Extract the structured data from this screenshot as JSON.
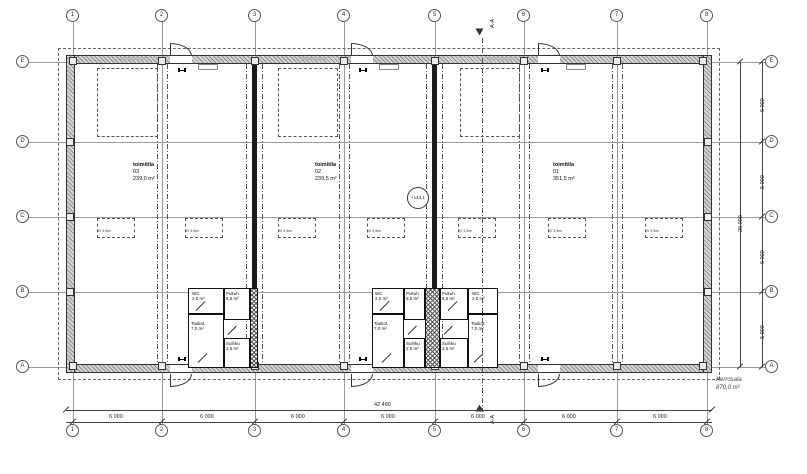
{
  "grid": {
    "cols": [
      "1",
      "2",
      "3",
      "4",
      "5",
      "6",
      "7",
      "8"
    ],
    "rows": [
      "E",
      "D",
      "C",
      "B",
      "A"
    ]
  },
  "dimensions": {
    "overall_width": "42 480",
    "bay_width": "6 000",
    "overall_height": "20 000",
    "row_height": "5 000"
  },
  "units": [
    {
      "label": "toimitila",
      "number": "03",
      "area": "239,0 m²"
    },
    {
      "label": "toimitila",
      "number": "02",
      "area": "239,5 m²"
    },
    {
      "label": "toimitila",
      "number": "01",
      "area": "351,5 m²"
    }
  ],
  "rooms": {
    "wc": {
      "name": "WC",
      "area": "2,0 m²"
    },
    "pukuh": {
      "name": "Pukuh.",
      "area": "5,5 m²"
    },
    "taukot": {
      "name": "Taukot.",
      "area": "7,0 m²"
    },
    "suihku": {
      "name": "Suihku",
      "area": "2,5 m²"
    }
  },
  "annotations": {
    "level": "+143,1",
    "section": "A-A",
    "floor_area_label": "Kerrosala",
    "floor_area_value": "870,0 m²",
    "reservation": "IV 3,5m²"
  }
}
